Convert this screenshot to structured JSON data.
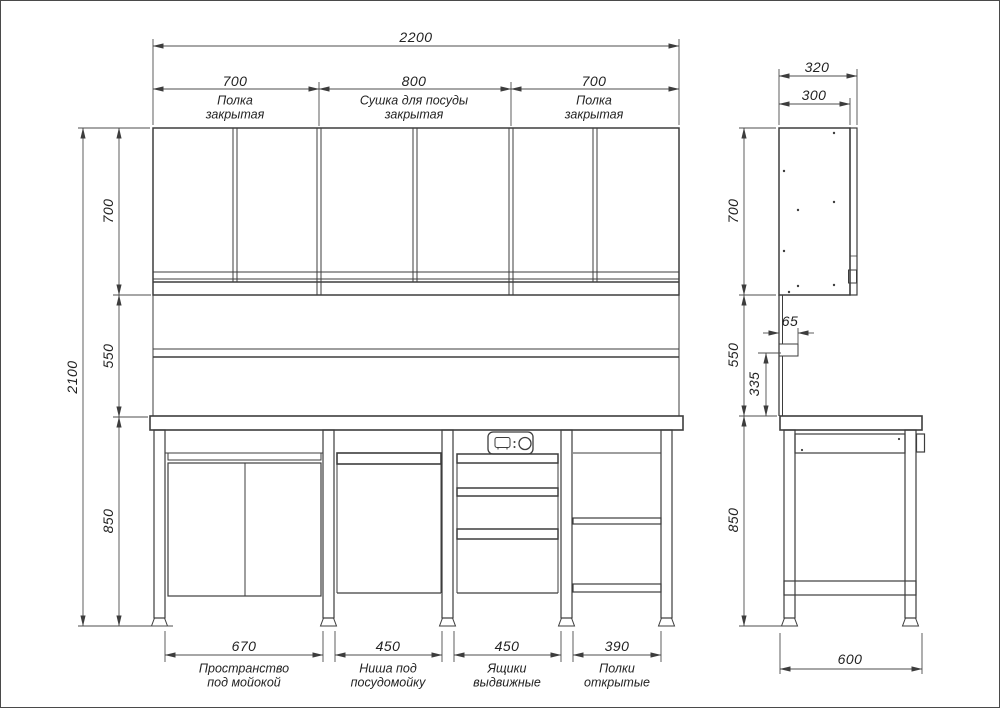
{
  "front_view": {
    "overall_width_dim": "2200",
    "overall_height_dim": "2100",
    "height_dims": {
      "upper": "700",
      "middle": "550",
      "lower": "850"
    },
    "top_sections": [
      {
        "dim": "700",
        "label1": "Полка",
        "label2": "закрытая"
      },
      {
        "dim": "800",
        "label1": "Сушка для посуды",
        "label2": "закрытая"
      },
      {
        "dim": "700",
        "label1": "Полка",
        "label2": "закрытая"
      }
    ],
    "bottom_sections": [
      {
        "dim": "670",
        "label1": "Пространство",
        "label2": "под мойокой"
      },
      {
        "dim": "450",
        "label1": "Ниша под",
        "label2": "посудомойку"
      },
      {
        "dim": "450",
        "label1": "Ящики",
        "label2": "выдвижные"
      },
      {
        "dim": "390",
        "label1": "Полки",
        "label2": "открытые"
      }
    ]
  },
  "side_view": {
    "depth_dims": {
      "overall": "320",
      "body": "300",
      "base": "600"
    },
    "height_dims": {
      "upper": "700",
      "middle": "550",
      "lower": "850"
    },
    "detail_dims": {
      "shelf_depth": "65",
      "shelf_to_worktop": "335"
    }
  },
  "colors": {
    "line": "#3d3d3d",
    "dim_line": "#555555",
    "text": "#222222"
  }
}
